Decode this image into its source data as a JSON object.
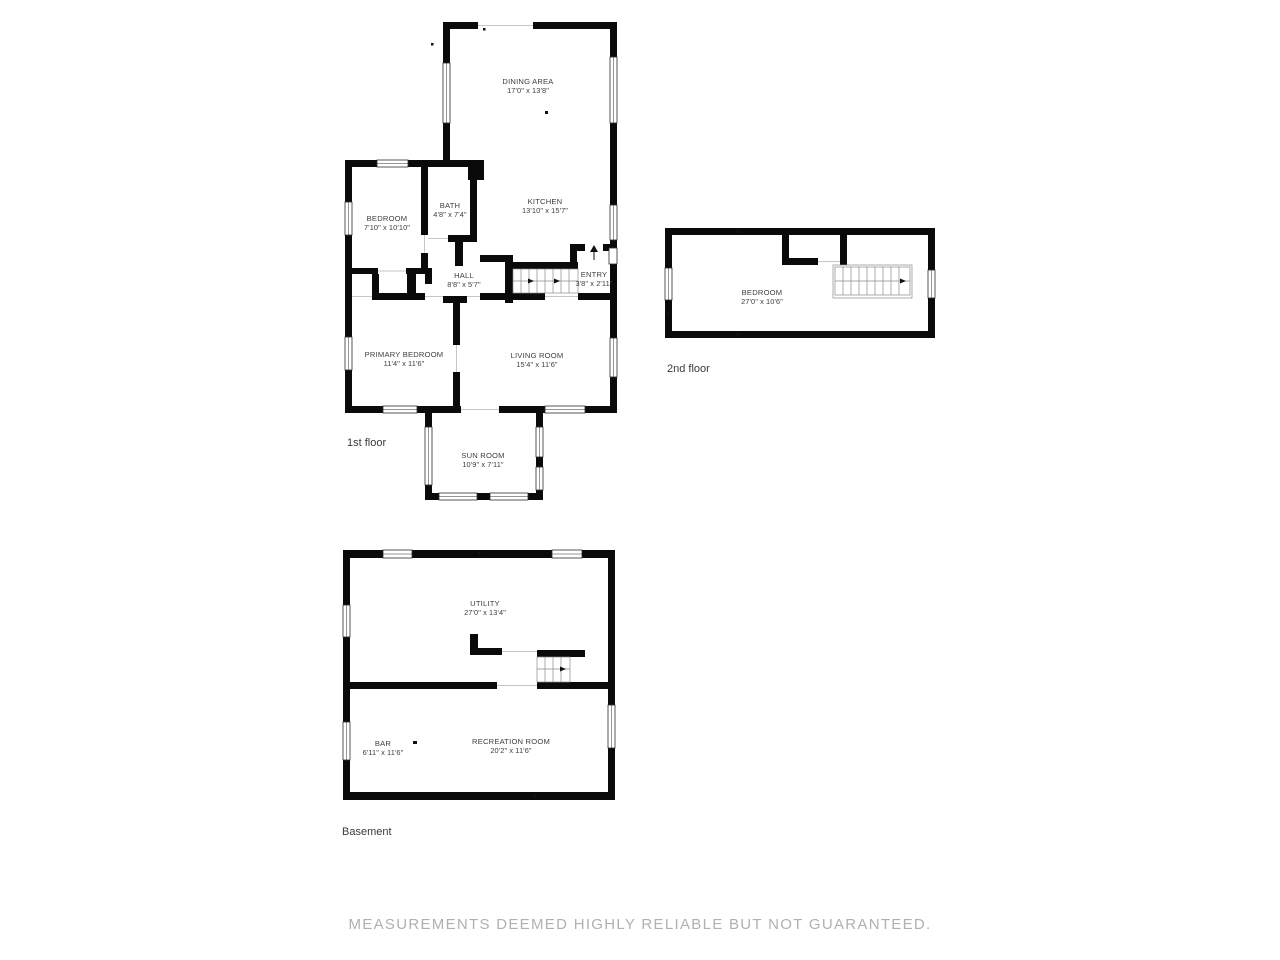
{
  "disclaimer": "MEASUREMENTS DEEMED HIGHLY RELIABLE BUT NOT GUARANTEED.",
  "floors": {
    "first": {
      "label": "1st floor",
      "rooms": {
        "dining": {
          "name": "DINING AREA",
          "dims": "17'0\" x 13'8\""
        },
        "kitchen": {
          "name": "KITCHEN",
          "dims": "13'10\" x 15'7\""
        },
        "bath": {
          "name": "BATH",
          "dims": "4'8\" x 7'4\""
        },
        "bedroom": {
          "name": "BEDROOM",
          "dims": "7'10\" x 10'10\""
        },
        "hall": {
          "name": "HALL",
          "dims": "8'8\" x 5'7\""
        },
        "entry": {
          "name": "ENTRY",
          "dims": "3'8\" x 2'11\""
        },
        "primary": {
          "name": "PRIMARY BEDROOM",
          "dims": "11'4\" x 11'6\""
        },
        "living": {
          "name": "LIVING ROOM",
          "dims": "15'4\" x 11'6\""
        },
        "sunroom": {
          "name": "SUN ROOM",
          "dims": "10'9\" x 7'11\""
        }
      }
    },
    "second": {
      "label": "2nd floor",
      "rooms": {
        "bedroom": {
          "name": "BEDROOM",
          "dims": "27'0\" x 10'6\""
        }
      }
    },
    "basement": {
      "label": "Basement",
      "rooms": {
        "utility": {
          "name": "UTILITY",
          "dims": "27'0\" x 13'4\""
        },
        "bar": {
          "name": "BAR",
          "dims": "6'11\" x 11'6\""
        },
        "recreation": {
          "name": "RECREATION ROOM",
          "dims": "20'2\" x 11'6\""
        }
      }
    }
  }
}
